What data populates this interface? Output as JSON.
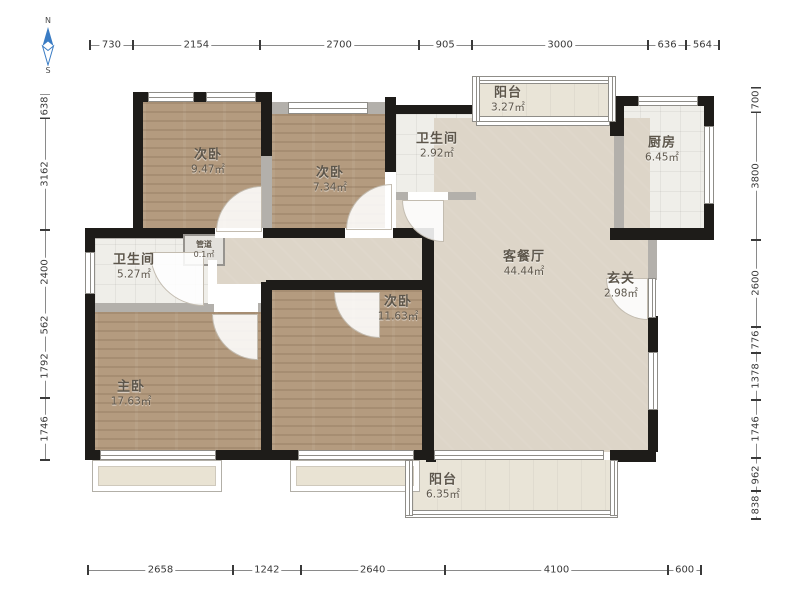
{
  "plan": {
    "compass": {
      "north": "N",
      "south": "S"
    },
    "rooms": [
      {
        "id": "bedroom-top-left",
        "name": "次卧",
        "area": "9.47㎡"
      },
      {
        "id": "bedroom-top-mid",
        "name": "次卧",
        "area": "7.34㎡"
      },
      {
        "id": "bathroom-top",
        "name": "卫生间",
        "area": "2.92㎡"
      },
      {
        "id": "balcony-top",
        "name": "阳台",
        "area": "3.27㎡"
      },
      {
        "id": "kitchen",
        "name": "厨房",
        "area": "6.45㎡"
      },
      {
        "id": "bathroom-left",
        "name": "卫生间",
        "area": "5.27㎡"
      },
      {
        "id": "duct",
        "name": "管道",
        "area": "0.1㎡"
      },
      {
        "id": "living-dining",
        "name": "客餐厅",
        "area": "44.44㎡"
      },
      {
        "id": "entry",
        "name": "玄关",
        "area": "2.98㎡"
      },
      {
        "id": "bedroom-mid",
        "name": "次卧",
        "area": "11.63㎡"
      },
      {
        "id": "master-bedroom",
        "name": "主卧",
        "area": "17.63㎡"
      },
      {
        "id": "balcony-bottom",
        "name": "阳台",
        "area": "6.35㎡"
      }
    ],
    "dimensions_mm": {
      "top": [
        "730",
        "2154",
        "2700",
        "905",
        "3000",
        "636",
        "564"
      ],
      "left": [
        "638",
        "3162",
        "2400",
        "562",
        "1792",
        "1746"
      ],
      "right": [
        "700",
        "3800",
        "2600",
        "776",
        "1378",
        "1746",
        "962",
        "838"
      ],
      "bottom": [
        "2658",
        "1242",
        "2640",
        "4100",
        "600"
      ]
    },
    "colors": {
      "wall": "#1e1c19",
      "wood_floor": "#b49b7f",
      "tile_floor": "#efeee9",
      "living_floor": "#ddd5c8",
      "balcony_floor": "#e9e4d7",
      "compass_arrow": "#3a7cc4"
    }
  }
}
